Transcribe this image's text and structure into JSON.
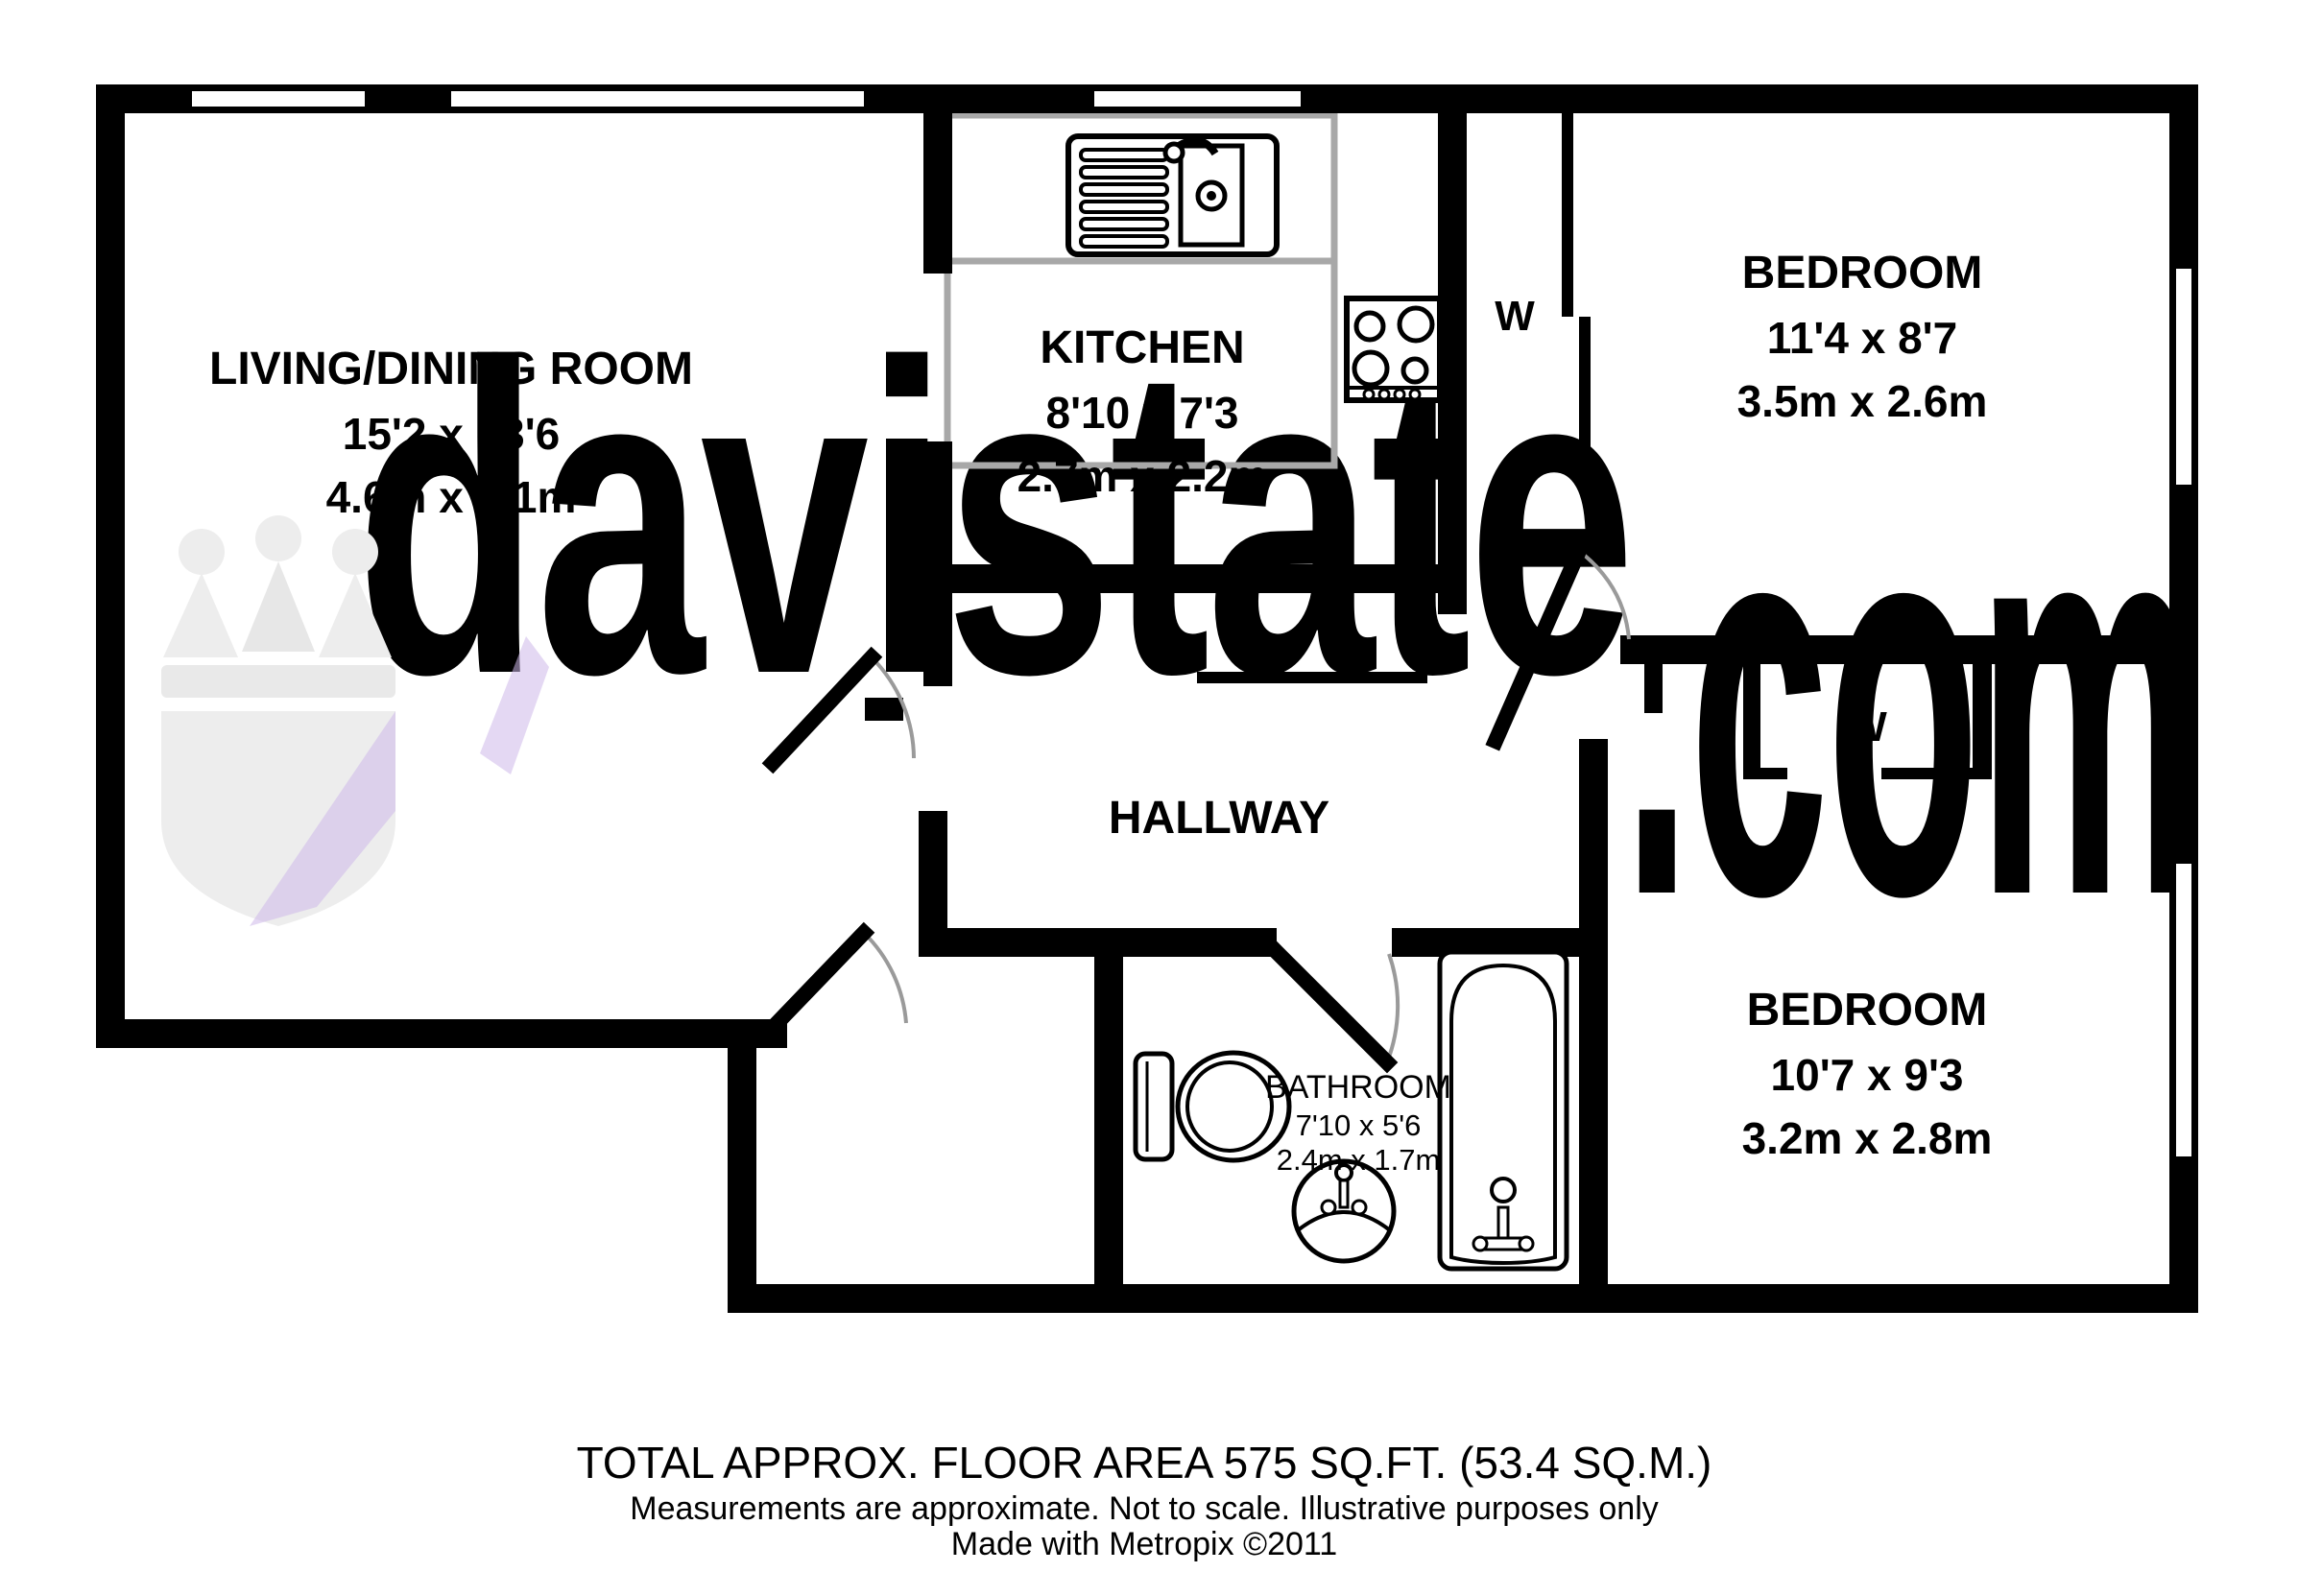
{
  "watermark": {
    "brand": "davistate",
    "tld": ".com",
    "purple": "#c8b2ec",
    "gray": "#e2e2e2"
  },
  "logo": {
    "gray": "#ededed",
    "purple": "#cdb8ea"
  },
  "plan_colors": {
    "wall": "#000000",
    "counter_gray": "#a8a8a8",
    "door_arc_gray": "#9a9a9a"
  },
  "rooms": {
    "living": {
      "name": "LIVING/DINING ROOM",
      "imperial": "15'2 x 13'6",
      "metric": "4.6m x 4.1m"
    },
    "kitchen": {
      "name": "KITCHEN",
      "imperial": "8'10 x 7'3",
      "metric": "2.7m x 2.2m"
    },
    "bedroom1": {
      "name": "BEDROOM",
      "imperial": "11'4 x 8'7",
      "metric": "3.5m x 2.6m"
    },
    "bedroom2": {
      "name": "BEDROOM",
      "imperial": "10'7 x 9'3",
      "metric": "3.2m x 2.8m"
    },
    "bathroom": {
      "name": "BATHROOM",
      "imperial": "7'10 x 5'6",
      "metric": "2.4m x 1.7m"
    },
    "hallway": {
      "name": "HALLWAY"
    },
    "wardrobe1": {
      "label": "W"
    },
    "wardrobe2": {
      "label": "W"
    }
  },
  "footer": {
    "line1": "TOTAL APPROX. FLOOR AREA 575 SQ.FT. (53.4 SQ.M.)",
    "line2": "Measurements are approximate.  Not to scale.  Illustrative purposes only",
    "line3": "Made with Metropix ©2011"
  }
}
